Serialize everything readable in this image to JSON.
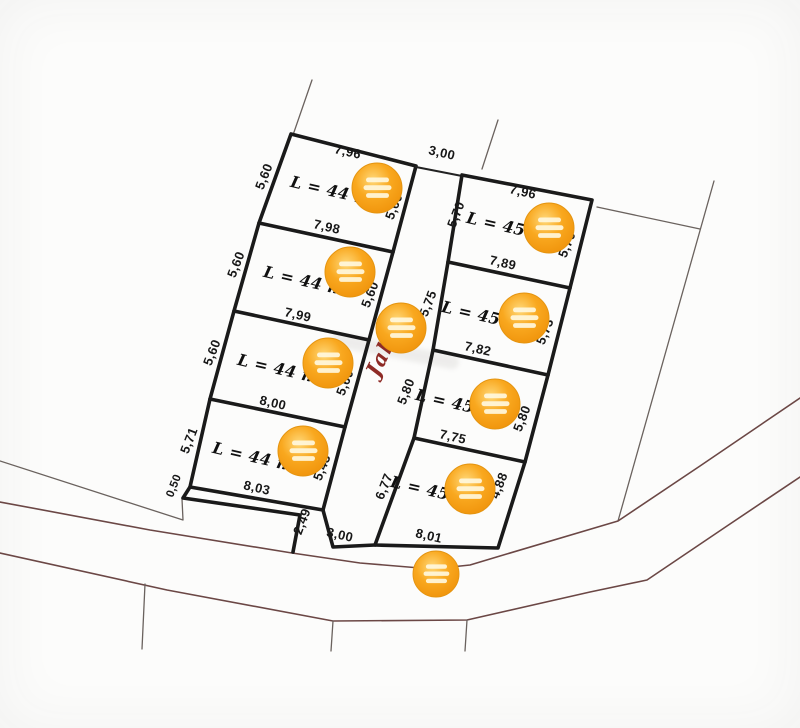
{
  "diagram": {
    "road_name": "Jala",
    "top_gap": "3,00",
    "bottom_gap": "3,00",
    "step_offsets": {
      "left": "0,50",
      "right": "2,49"
    }
  },
  "left_plots": [
    {
      "area": "L = 44 m",
      "top": "7,96",
      "left": "5,60",
      "right": "5,60",
      "bottom": "7,98"
    },
    {
      "area": "L = 44 m",
      "left": "5,60",
      "right": "5,60",
      "bottom": "7,99"
    },
    {
      "area": "L = 44 m",
      "left": "5,60",
      "right": "5,60",
      "bottom": "8,00"
    },
    {
      "area": "L = 44 m",
      "left": "5,71",
      "right": "5,43",
      "bottom": "8,03"
    }
  ],
  "right_plots": [
    {
      "area": "L = 45 m",
      "top": "7,96",
      "left": "5,70",
      "right": "5,70",
      "bottom": "7,89"
    },
    {
      "area": "L = 45 m",
      "left": "5,75",
      "right": "5,73",
      "bottom": "7,82"
    },
    {
      "area": "L = 45 m",
      "left": "5,80",
      "right": "5,80",
      "bottom": "7,75"
    },
    {
      "area": "L = 45 m",
      "left": "6,77",
      "right": "4,88",
      "bottom": "8,01"
    }
  ],
  "marker": {
    "icon": "orange-location-marker-icon"
  },
  "colors": {
    "plot_line": "#1a1a1a",
    "street_line": "#6b4745",
    "thin_boundary": "#6a625e",
    "marker_orange": "#f7a41d",
    "road_text": "#8e2b26",
    "background": "#fcfcfb"
  }
}
